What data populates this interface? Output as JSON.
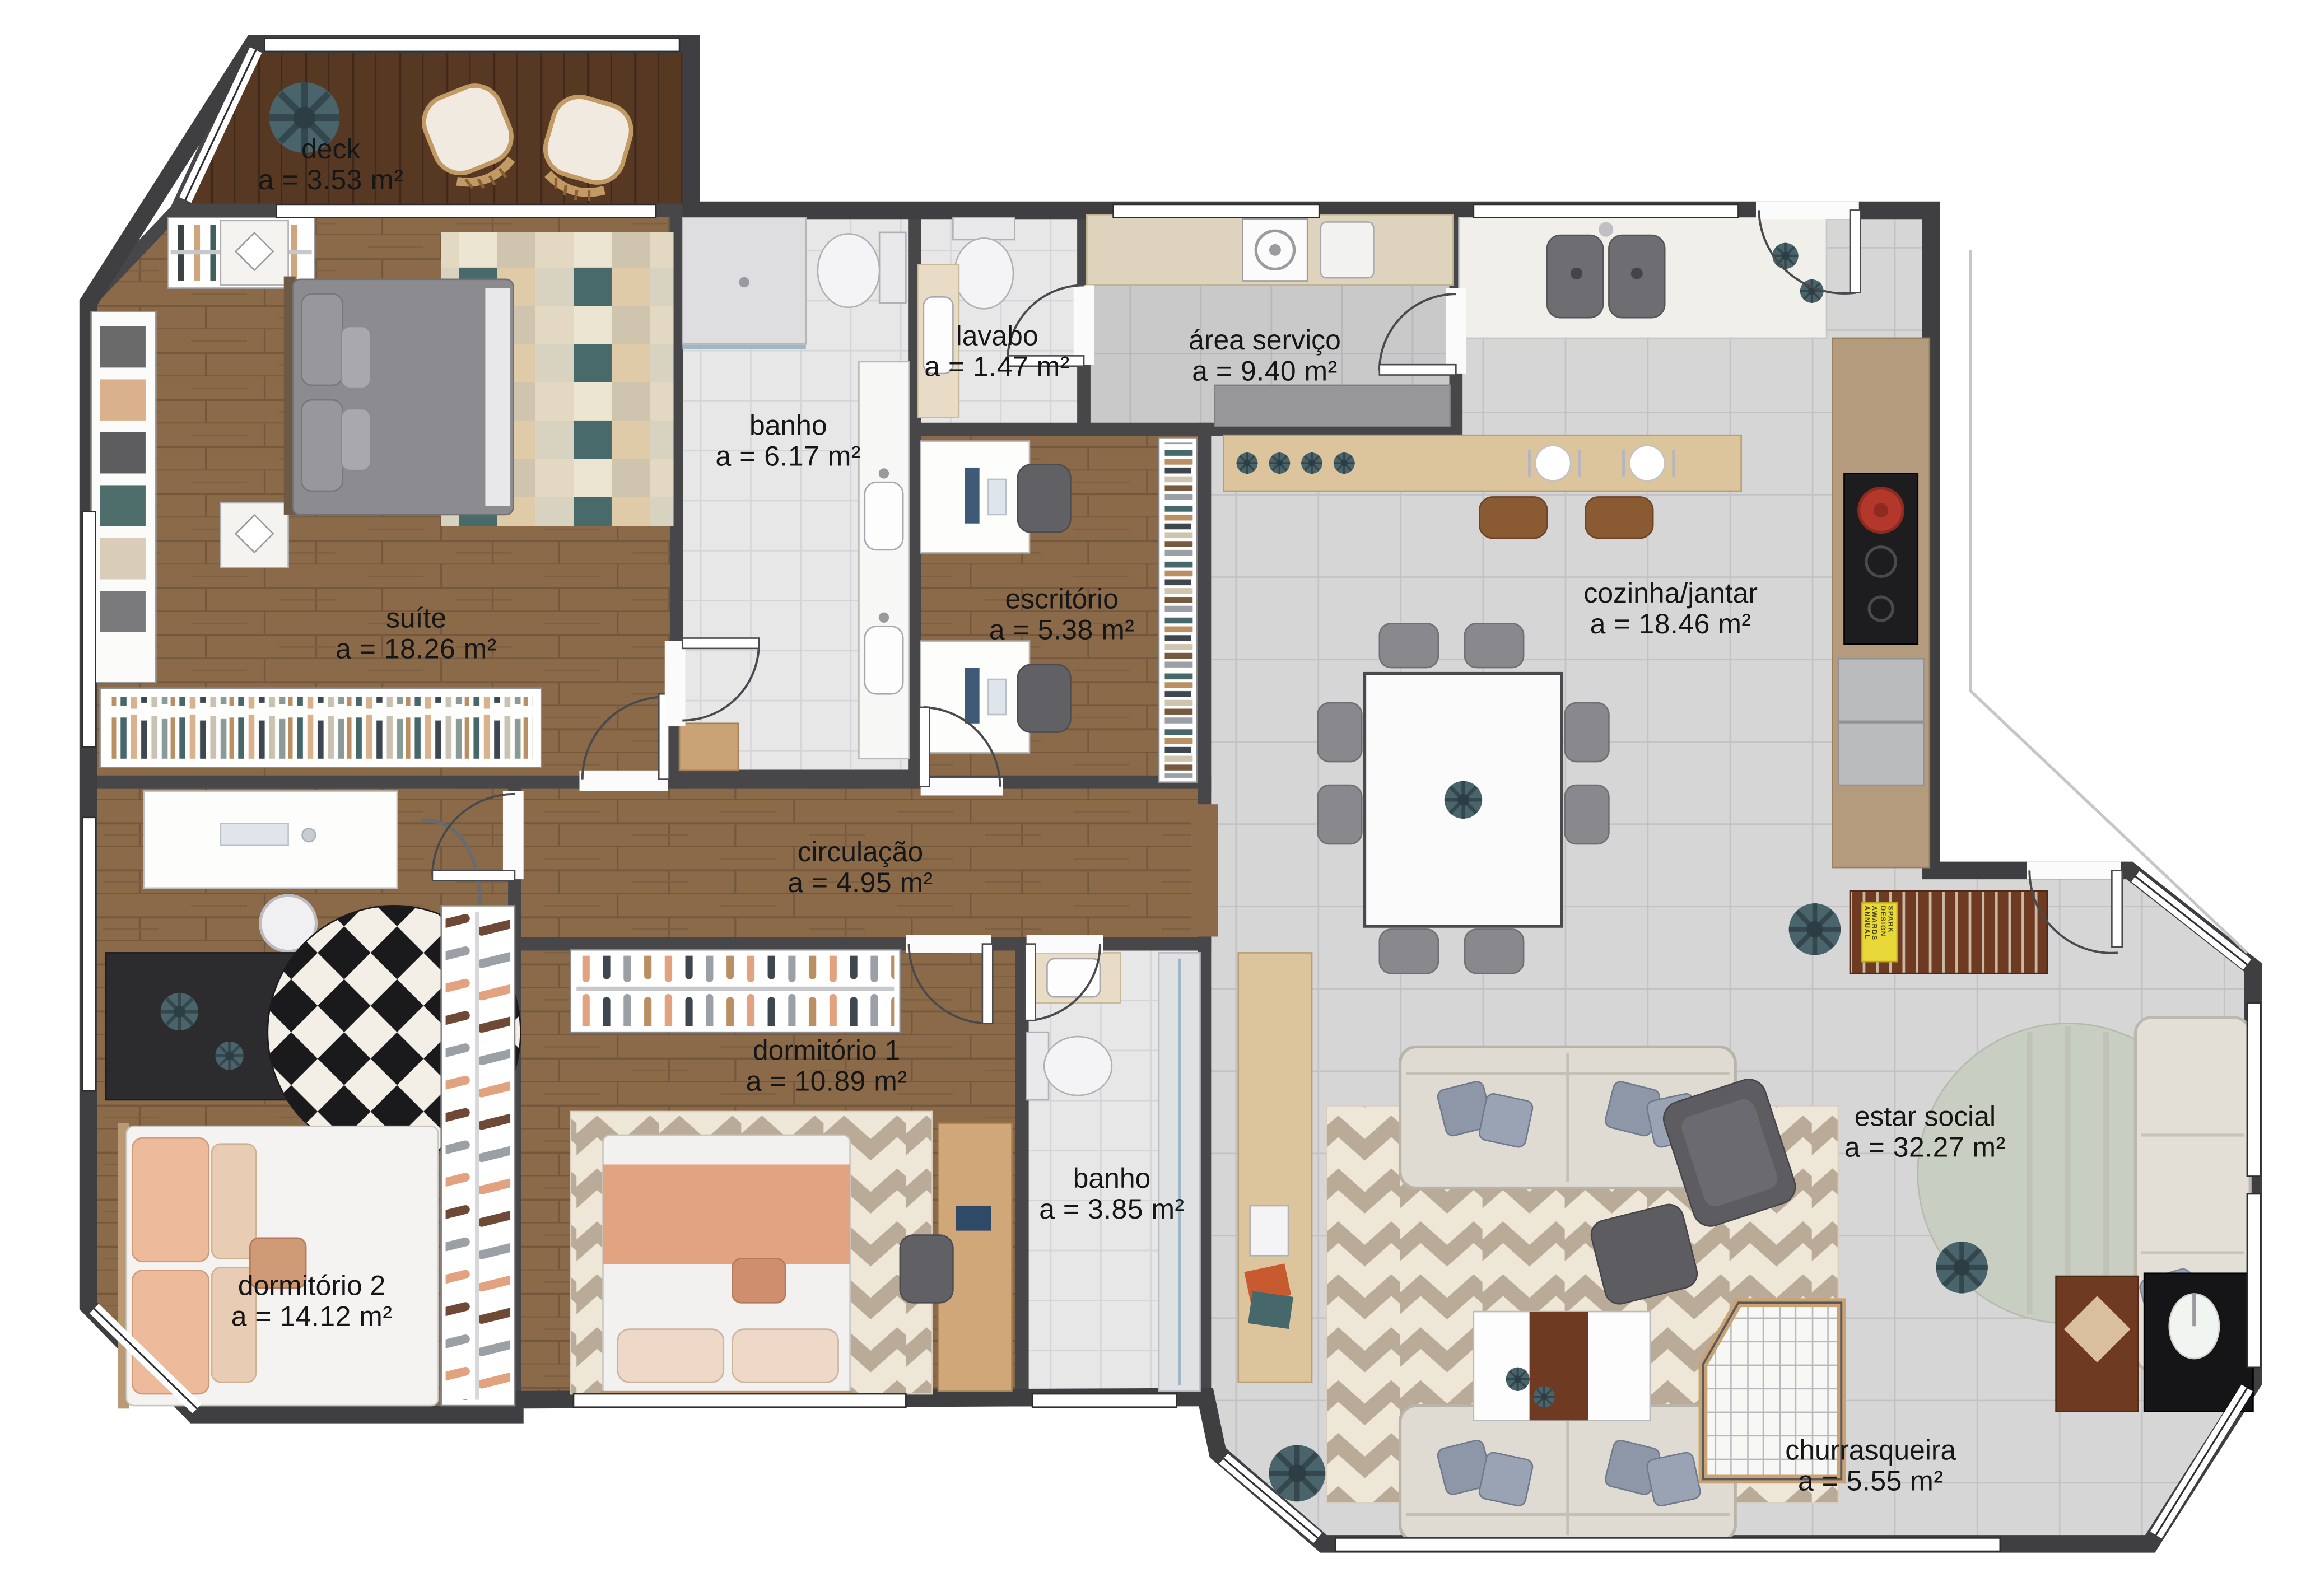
{
  "plan": {
    "type": "apartment-floor-plan",
    "rooms": [
      {
        "key": "deck",
        "name": "deck",
        "area": "a = 3.53 m²"
      },
      {
        "key": "suite",
        "name": "suíte",
        "area": "a = 18.26 m²"
      },
      {
        "key": "banho_suite",
        "name": "banho",
        "area": "a = 6.17 m²"
      },
      {
        "key": "lavabo",
        "name": "lavabo",
        "area": "a = 1.47 m²"
      },
      {
        "key": "area_servico",
        "name": "área serviço",
        "area": "a = 9.40 m²"
      },
      {
        "key": "escritorio",
        "name": "escritório",
        "area": "a = 5.38 m²"
      },
      {
        "key": "cozinha_jantar",
        "name": "cozinha/jantar",
        "area": "a = 18.46 m²"
      },
      {
        "key": "circulacao",
        "name": "circulação",
        "area": "a = 4.95 m²"
      },
      {
        "key": "dormitorio_1",
        "name": "dormitório 1",
        "area": "a = 10.89 m²"
      },
      {
        "key": "dormitorio_2",
        "name": "dormitório 2",
        "area": "a = 14.12 m²"
      },
      {
        "key": "banho_social",
        "name": "banho",
        "area": "a = 3.85 m²"
      },
      {
        "key": "estar_social",
        "name": "estar social",
        "area": "a = 32.27 m²"
      },
      {
        "key": "churrasqueira",
        "name": "churrasqueira",
        "area": "a = 5.55 m²"
      }
    ],
    "decor_text": {
      "sideboard_book": "SPARK DESIGN AWARDS ANNUAL"
    },
    "colors": {
      "wall": "#47474a",
      "wood_floor": "#8b6a49",
      "deck_wood": "#573823",
      "tile_light": "#d6d6d7",
      "tile_bath": "#e7e7e8",
      "tile_service": "#c9c9ca",
      "counter_tan": "#b59b7e",
      "counter_wood": "#dcc49c",
      "plant_teal": "#4a646c",
      "sofa_cream": "#dfdbd2",
      "rug_chevron_bg": "#eee6d6",
      "rug_chevron_stripe": "#b9ab97",
      "accent_salmon": "#e3a27f",
      "book_yellow": "#e8d838"
    }
  }
}
